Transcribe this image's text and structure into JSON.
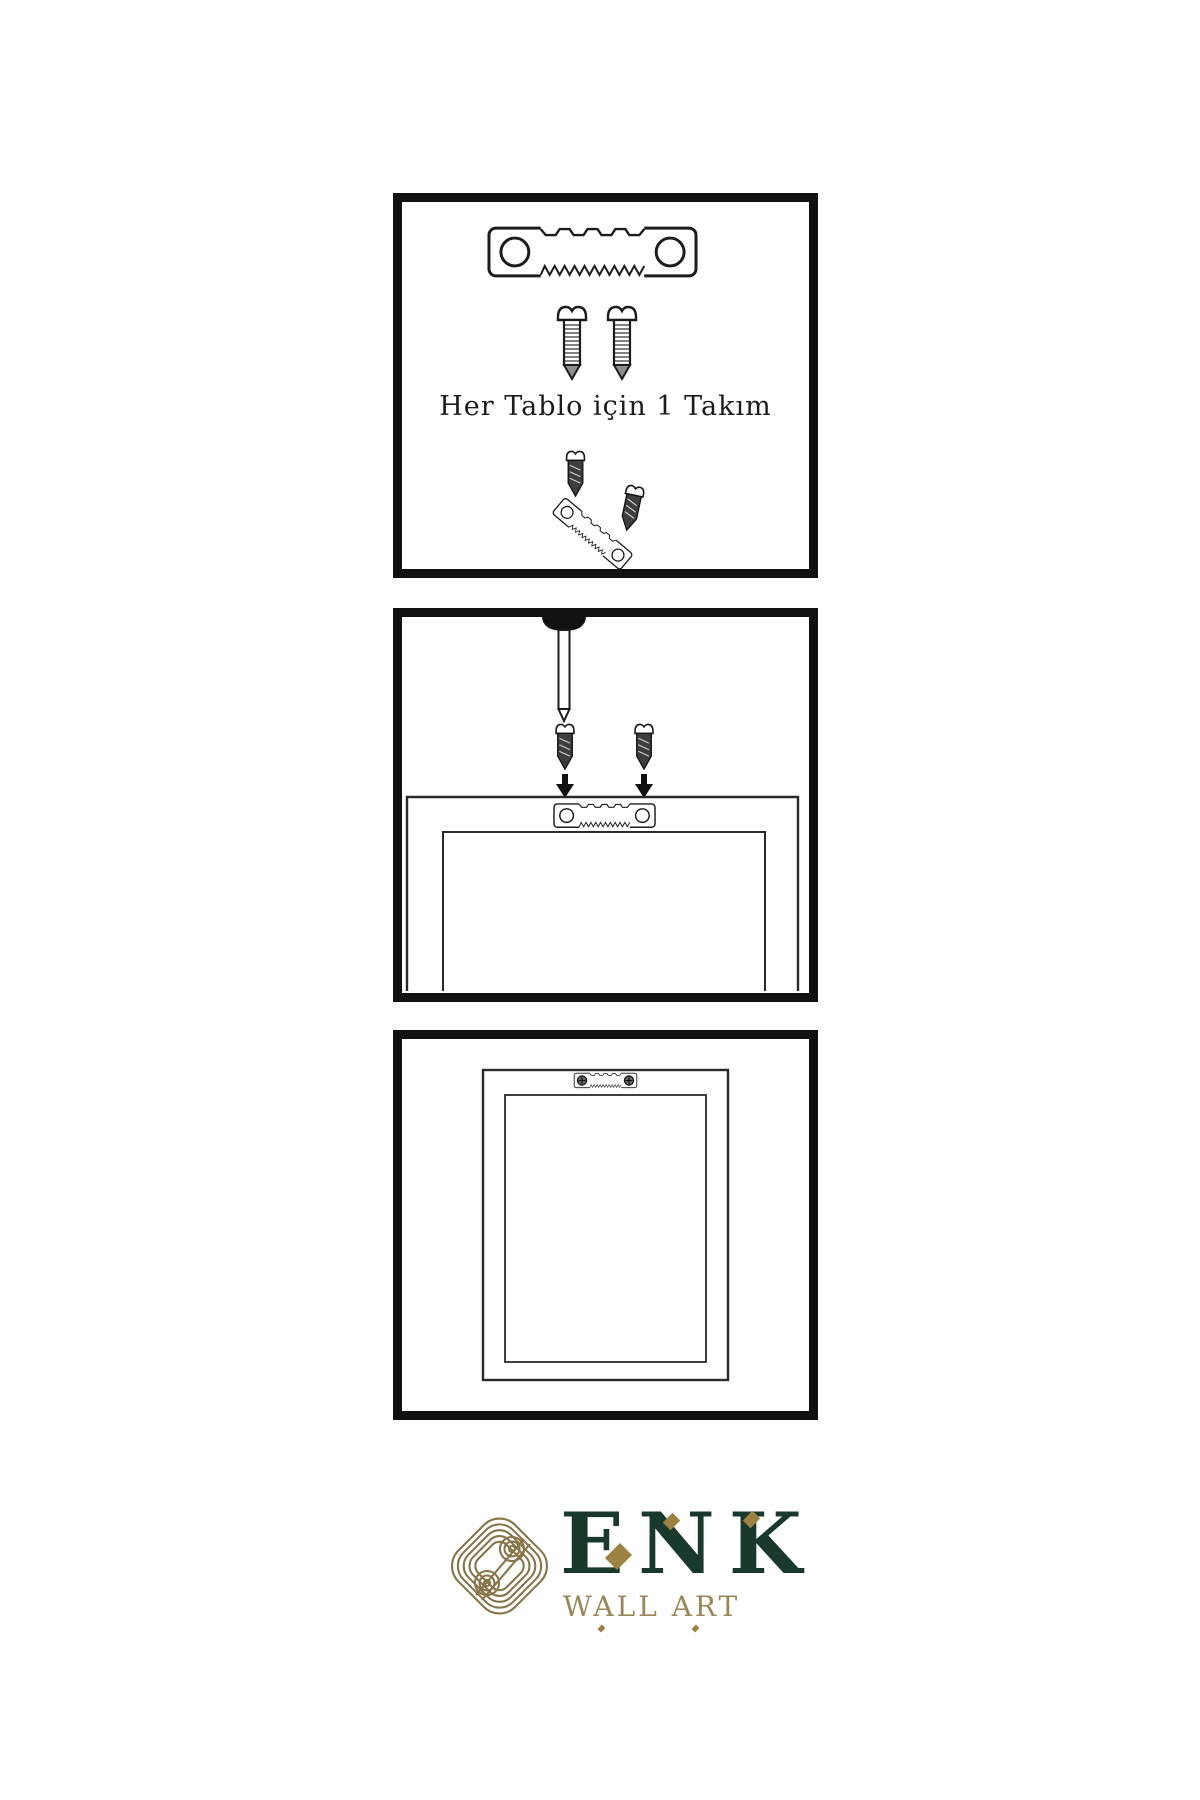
{
  "panel1": {
    "caption": "Her Tablo için 1 Takım"
  },
  "logo": {
    "title": "ENK",
    "subtitle": "WALL ART"
  },
  "colors": {
    "ink": "#1c1c1c",
    "panel_border": "#111111",
    "screw_dark": "#3d3d3d",
    "logo_green": "#1a392d",
    "logo_gold": "#9a8656",
    "knot_gold": "#877549",
    "background": "#ffffff"
  }
}
